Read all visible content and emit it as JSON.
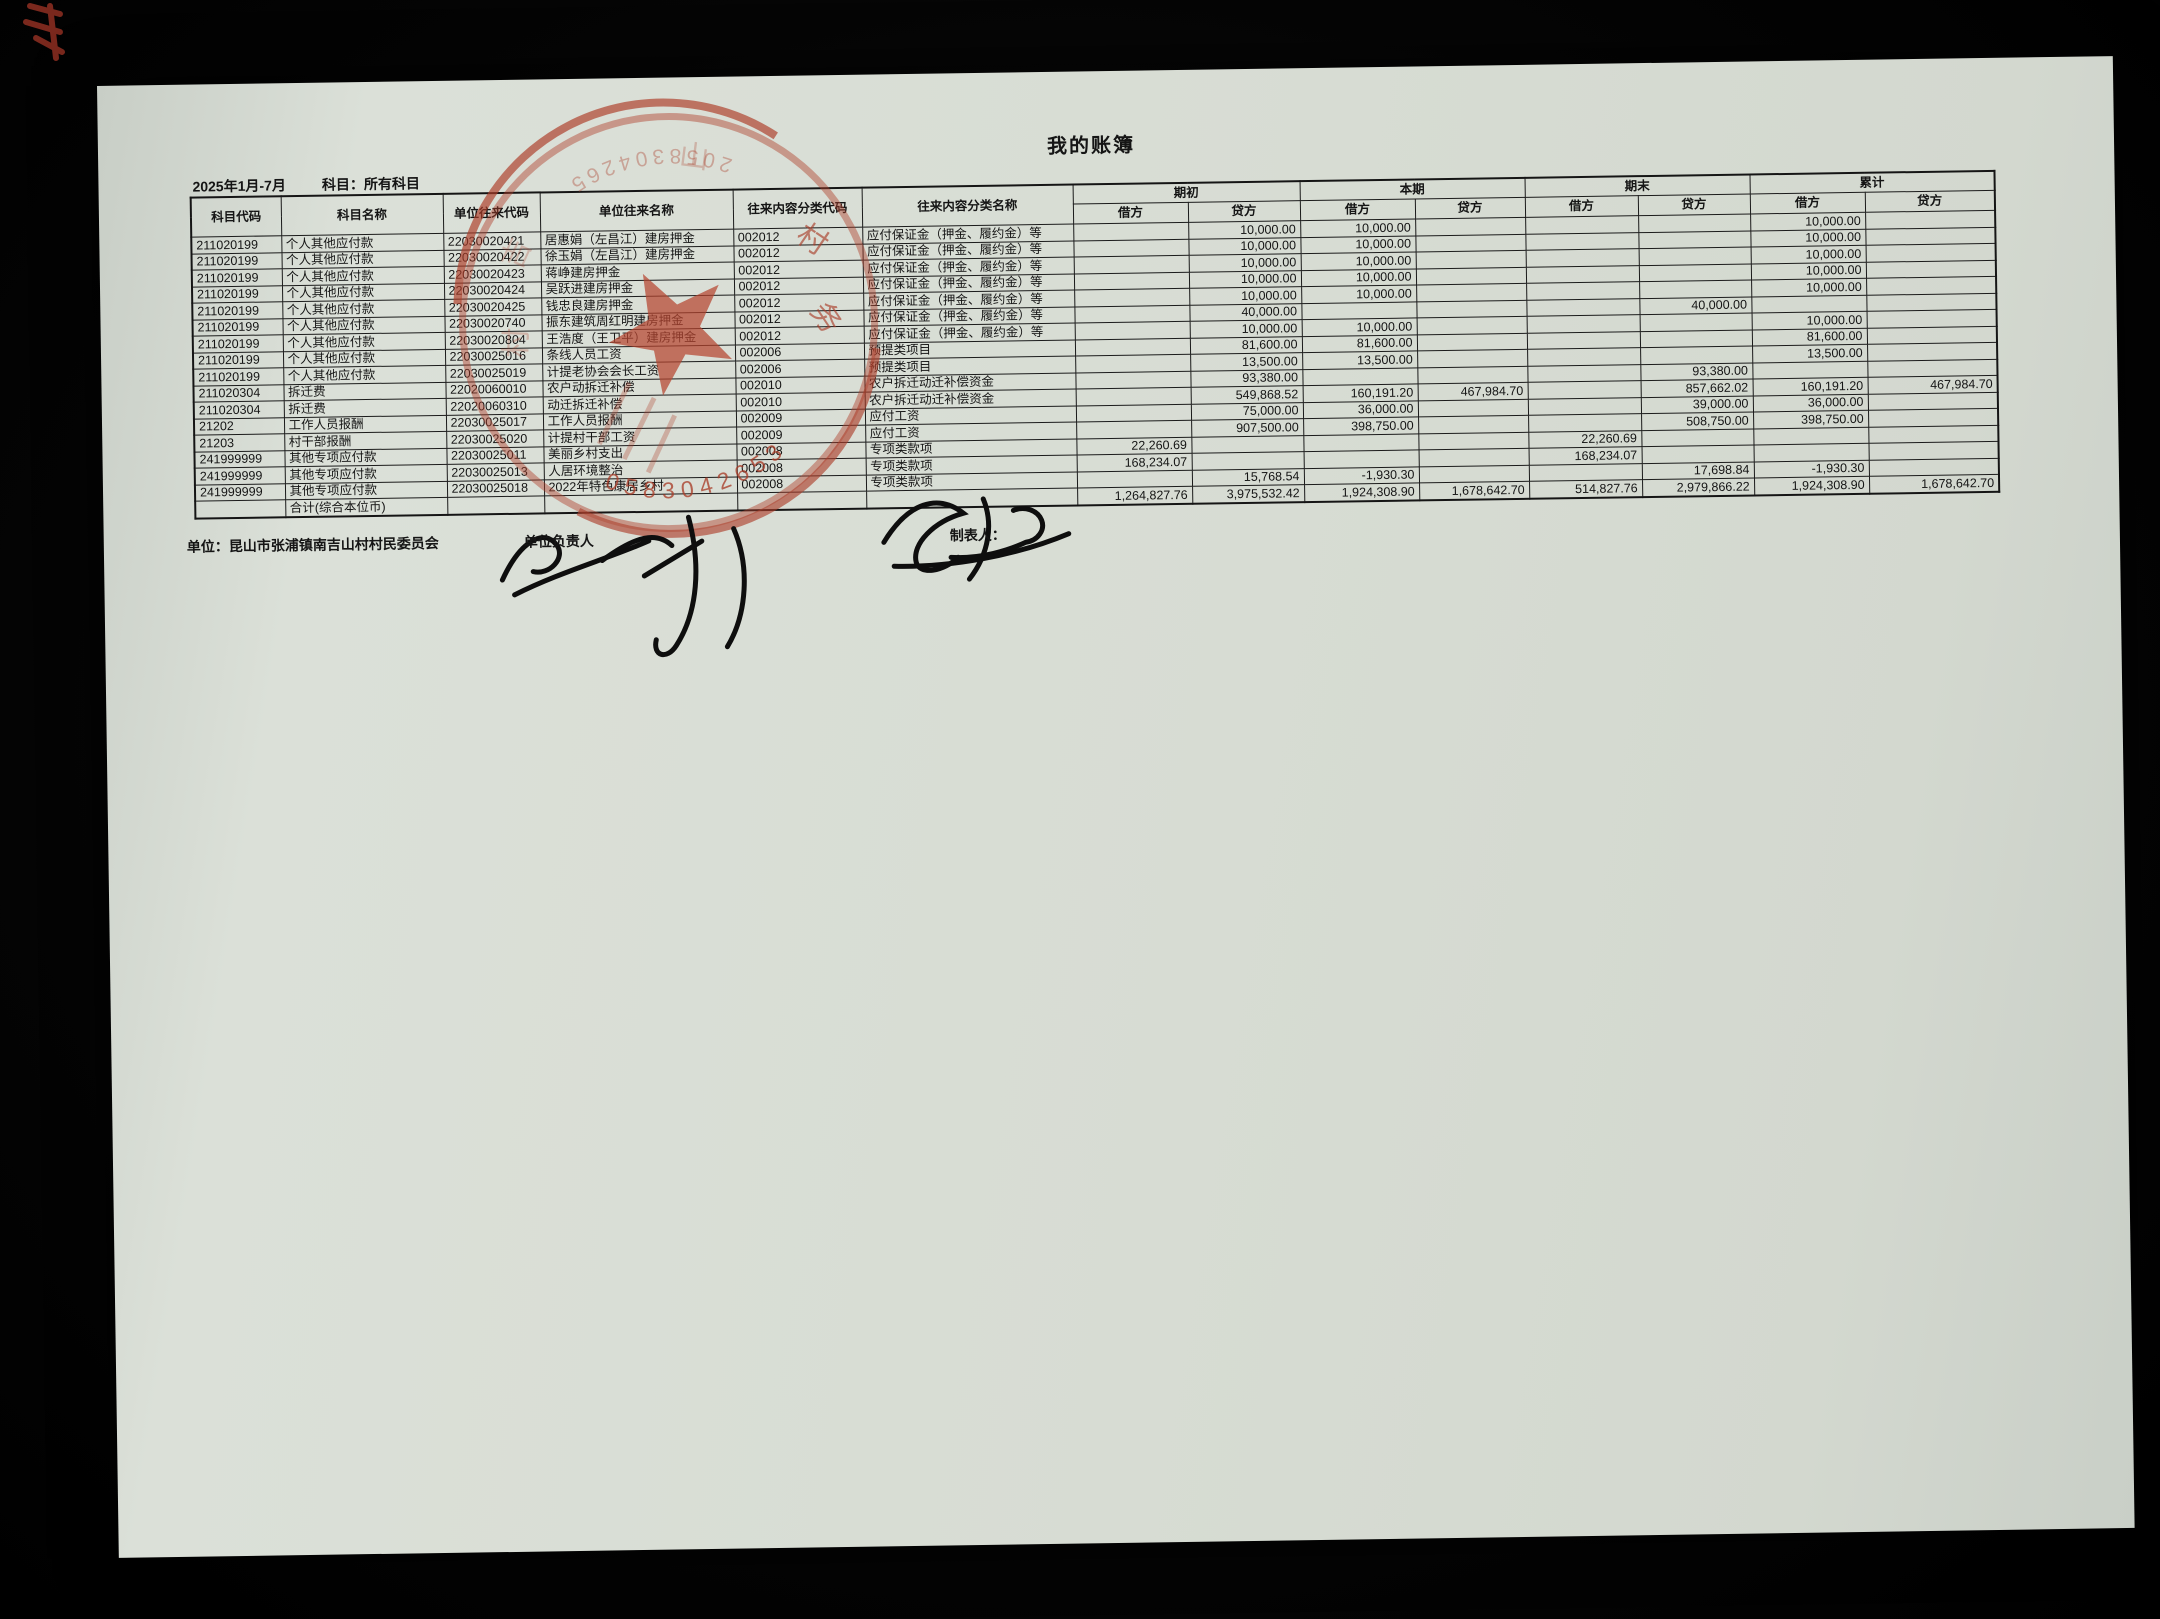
{
  "page": {
    "title": "我的账簿",
    "period": "2025年1月-7月",
    "subject_filter": "科目：所有科目"
  },
  "table": {
    "columns": [
      "科目代码",
      "科目名称",
      "单位往来代码",
      "单位往来名称",
      "往来内容分类代码",
      "往来内容分类名称"
    ],
    "groups": [
      "期初",
      "本期",
      "期末",
      "累计"
    ],
    "sub_headers": [
      "借方",
      "贷方"
    ],
    "rows": [
      [
        "211020199",
        "个人其他应付款",
        "22030020421",
        "居惠娟（左昌江）建房押金",
        "002012",
        "应付保证金（押金、履约金）等",
        "",
        "10,000.00",
        "10,000.00",
        "",
        "",
        "",
        "10,000.00",
        ""
      ],
      [
        "211020199",
        "个人其他应付款",
        "22030020422",
        "徐玉娟（左昌江）建房押金",
        "002012",
        "应付保证金（押金、履约金）等",
        "",
        "10,000.00",
        "10,000.00",
        "",
        "",
        "",
        "10,000.00",
        ""
      ],
      [
        "211020199",
        "个人其他应付款",
        "22030020423",
        "蒋峥建房押金",
        "002012",
        "应付保证金（押金、履约金）等",
        "",
        "10,000.00",
        "10,000.00",
        "",
        "",
        "",
        "10,000.00",
        ""
      ],
      [
        "211020199",
        "个人其他应付款",
        "22030020424",
        "吴跃进建房押金",
        "002012",
        "应付保证金（押金、履约金）等",
        "",
        "10,000.00",
        "10,000.00",
        "",
        "",
        "",
        "10,000.00",
        ""
      ],
      [
        "211020199",
        "个人其他应付款",
        "22030020425",
        "钱忠良建房押金",
        "002012",
        "应付保证金（押金、履约金）等",
        "",
        "10,000.00",
        "10,000.00",
        "",
        "",
        "",
        "10,000.00",
        ""
      ],
      [
        "211020199",
        "个人其他应付款",
        "22030020740",
        "振东建筑周红明建房押金",
        "002012",
        "应付保证金（押金、履约金）等",
        "",
        "40,000.00",
        "",
        "",
        "",
        "40,000.00",
        "",
        ""
      ],
      [
        "211020199",
        "个人其他应付款",
        "22030020804",
        "王浩度（王卫平）建房押金",
        "002012",
        "应付保证金（押金、履约金）等",
        "",
        "10,000.00",
        "10,000.00",
        "",
        "",
        "",
        "10,000.00",
        ""
      ],
      [
        "211020199",
        "个人其他应付款",
        "22030025016",
        "条线人员工资",
        "002006",
        "预提类项目",
        "",
        "81,600.00",
        "81,600.00",
        "",
        "",
        "",
        "81,600.00",
        ""
      ],
      [
        "211020199",
        "个人其他应付款",
        "22030025019",
        "计提老协会会长工资",
        "002006",
        "预提类项目",
        "",
        "13,500.00",
        "13,500.00",
        "",
        "",
        "",
        "13,500.00",
        ""
      ],
      [
        "211020304",
        "拆迁费",
        "22020060010",
        "农户动拆迁补偿",
        "002010",
        "农户拆迁动迁补偿资金",
        "",
        "93,380.00",
        "",
        "",
        "",
        "93,380.00",
        "",
        ""
      ],
      [
        "211020304",
        "拆迁费",
        "22020060310",
        "动迁拆迁补偿",
        "002010",
        "农户拆迁动迁补偿资金",
        "",
        "549,868.52",
        "160,191.20",
        "467,984.70",
        "",
        "857,662.02",
        "160,191.20",
        "467,984.70"
      ],
      [
        "21202",
        "工作人员报酬",
        "22030025017",
        "工作人员报酬",
        "002009",
        "应付工资",
        "",
        "75,000.00",
        "36,000.00",
        "",
        "",
        "39,000.00",
        "36,000.00",
        ""
      ],
      [
        "21203",
        "村干部报酬",
        "22030025020",
        "计提村干部工资",
        "002009",
        "应付工资",
        "",
        "907,500.00",
        "398,750.00",
        "",
        "",
        "508,750.00",
        "398,750.00",
        ""
      ],
      [
        "241999999",
        "其他专项应付款",
        "22030025011",
        "美丽乡村支出",
        "002008",
        "专项类款项",
        "22,260.69",
        "",
        "",
        "",
        "22,260.69",
        "",
        "",
        ""
      ],
      [
        "241999999",
        "其他专项应付款",
        "22030025013",
        "人居环境整治",
        "002008",
        "专项类款项",
        "168,234.07",
        "",
        "",
        "",
        "168,234.07",
        "",
        "",
        ""
      ],
      [
        "241999999",
        "其他专项应付款",
        "22030025018",
        "2022年特色康居乡村",
        "002008",
        "专项类款项",
        "",
        "15,768.54",
        "-1,930.30",
        "",
        "",
        "17,698.84",
        "-1,930.30",
        ""
      ]
    ],
    "total_row": [
      "",
      "合计(综合本位币)",
      "",
      "",
      "",
      "",
      "1,264,827.76",
      "3,975,532.42",
      "1,924,308.90",
      "1,678,642.70",
      "514,827.76",
      "2,979,866.22",
      "1,924,308.90",
      "1,678,642.70"
    ],
    "col_widths": [
      90,
      162,
      97,
      193,
      129,
      211,
      115,
      112,
      115,
      110,
      113,
      112,
      115,
      130
    ]
  },
  "footer": {
    "unit_label": "单位：昆山市张浦镇南吉山村村民委员会",
    "manager_label": "单位负责人",
    "preparer_label": "制表人："
  },
  "stamp": {
    "type": "round-official-seal",
    "color": "#b0402c",
    "center_star": true,
    "visible_digits": "0583042653",
    "visible_chars": "村务"
  }
}
